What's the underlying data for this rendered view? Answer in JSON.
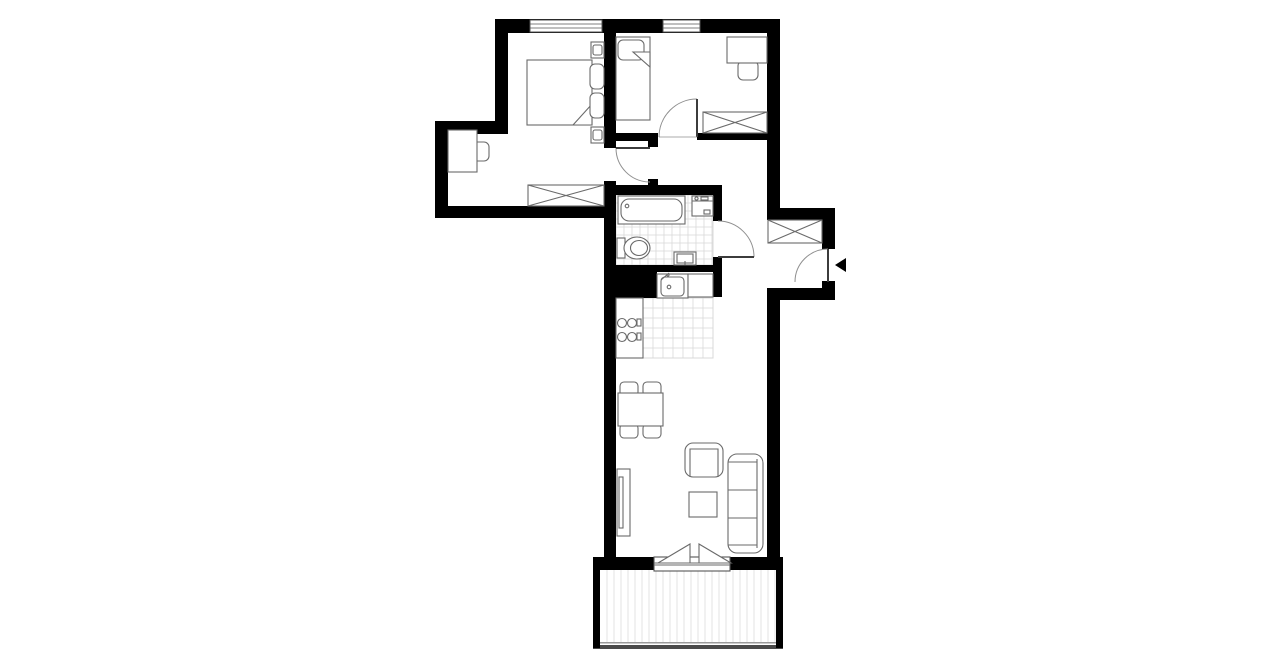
{
  "canvas": {
    "w": 1280,
    "h": 667,
    "bg": "#ffffff"
  },
  "palette": {
    "wall": "#000000",
    "line": "#6a6a6a",
    "leaf": "#3c3c3c",
    "arc": "#8f8f8f",
    "tile": "#d8d8d8",
    "deck": "#e3e3e3",
    "rail_light": "#9a9a9a",
    "rail_dark": "#4a4a4a",
    "window_frame": "#555555",
    "white": "#ffffff"
  },
  "walls": [
    {
      "name": "top-wall",
      "r": [
        495,
        19,
        285,
        14
      ]
    },
    {
      "name": "bedroom1-left-wall-upper",
      "r": [
        495,
        19,
        13,
        102
      ]
    },
    {
      "name": "bedroom1-step-wall",
      "r": [
        435,
        121,
        73,
        13
      ]
    },
    {
      "name": "bedroom1-left-wall-lower",
      "r": [
        435,
        121,
        13,
        97
      ]
    },
    {
      "name": "bedroom1-bottom-wall",
      "r": [
        435,
        206,
        181,
        12
      ]
    },
    {
      "name": "bedroom-divider-wall",
      "r": [
        604,
        33,
        12,
        115
      ]
    },
    {
      "name": "core-left-wall",
      "r": [
        604,
        181,
        12,
        389
      ]
    },
    {
      "name": "bedroom2-bottom-wall-left",
      "r": [
        616,
        133,
        42,
        8
      ]
    },
    {
      "name": "bedroom2-doorstop-nub",
      "r": [
        648,
        140,
        10,
        7
      ]
    },
    {
      "name": "bedroom2-bottom-wall-right",
      "r": [
        697,
        133,
        70,
        7
      ]
    },
    {
      "name": "right-wall-upper",
      "r": [
        767,
        19,
        13,
        201
      ]
    },
    {
      "name": "entry-step-wall",
      "r": [
        767,
        208,
        68,
        12
      ]
    },
    {
      "name": "entry-right-wall-upper",
      "r": [
        822,
        220,
        13,
        29
      ]
    },
    {
      "name": "entry-right-wall-stub",
      "r": [
        822,
        281,
        13,
        19
      ]
    },
    {
      "name": "entry-bottom-wall",
      "r": [
        767,
        288,
        68,
        12
      ]
    },
    {
      "name": "right-wall-lower",
      "r": [
        767,
        288,
        13,
        282
      ]
    },
    {
      "name": "bathroom-top-wall",
      "r": [
        616,
        185,
        106,
        10
      ]
    },
    {
      "name": "bathroom-doorstop-nub",
      "r": [
        648,
        179,
        10,
        6
      ]
    },
    {
      "name": "bathroom-right-wall-upper",
      "r": [
        713,
        195,
        9,
        26
      ]
    },
    {
      "name": "bathroom-right-wall-lower",
      "r": [
        713,
        257,
        9,
        15
      ]
    },
    {
      "name": "bathroom-bottom-wall",
      "r": [
        604,
        265,
        118,
        7
      ]
    },
    {
      "name": "kitchen-shaft",
      "r": [
        604,
        272,
        53,
        26
      ]
    },
    {
      "name": "kitchen-right-wall",
      "r": [
        713,
        272,
        9,
        25
      ]
    },
    {
      "name": "living-bottom-wall-left",
      "r": [
        593,
        557,
        61,
        13
      ]
    },
    {
      "name": "living-bottom-wall-right",
      "r": [
        730,
        557,
        53,
        13
      ]
    },
    {
      "name": "balcony-left-wall",
      "r": [
        593,
        570,
        7,
        78
      ]
    },
    {
      "name": "balcony-right-wall",
      "r": [
        776,
        570,
        7,
        78
      ]
    }
  ],
  "windows": [
    {
      "name": "bedroom1-window",
      "r": [
        530,
        20,
        72,
        12
      ]
    },
    {
      "name": "bedroom2-window",
      "r": [
        663,
        20,
        37,
        12
      ]
    }
  ],
  "tiles": [
    {
      "name": "bathroom-floor",
      "r": [
        616,
        195,
        97,
        70
      ],
      "size": 8
    },
    {
      "name": "kitchen-floor",
      "r": [
        643,
        298,
        70,
        60
      ],
      "size": 10
    }
  ],
  "balcony": {
    "deck": [
      600,
      570,
      176,
      72
    ],
    "deck_spacing": 7,
    "rail_top": [
      593,
      642,
      190,
      1.5
    ],
    "rail_bottom": [
      593,
      645,
      190,
      4
    ]
  },
  "doors": [
    {
      "name": "bedroom1-door",
      "leaf": [
        616,
        148,
        650,
        148
      ],
      "arc": "M 616 148 A 34 34 0 0 0 650 182"
    },
    {
      "name": "bedroom2-door",
      "leaf": [
        697,
        99,
        697,
        137
      ],
      "arc": "M 697 99 A 38 38 0 0 0 659 137",
      "threshold": [
        659,
        137,
        697,
        137
      ]
    },
    {
      "name": "bathroom-door",
      "leaf": [
        718,
        257,
        754,
        257
      ],
      "arc": "M 754 257 A 36 36 0 0 0 718 221"
    },
    {
      "name": "entrance-door",
      "leaf": [
        828,
        249,
        828,
        282
      ],
      "arc": "M 795 282 A 33 33 0 0 1 828 249"
    }
  ],
  "furniture": [
    {
      "name": "bedroom1-desk-chair",
      "shapes": [
        {
          "t": "rect",
          "r": [
            469,
            142,
            20,
            19
          ],
          "rx": 5,
          "f": "#fff"
        }
      ]
    },
    {
      "name": "bedroom1-desk",
      "shapes": [
        {
          "t": "rect",
          "r": [
            448,
            130,
            29,
            42
          ],
          "f": "#fff"
        }
      ]
    },
    {
      "name": "bedroom1-bed",
      "shapes": [
        {
          "t": "rect",
          "r": [
            527,
            60,
            65,
            65
          ],
          "f": "#fff"
        },
        {
          "t": "poly",
          "p": "573,125 592,104 592,125",
          "f": "#fff"
        },
        {
          "t": "rect",
          "r": [
            590,
            64,
            14,
            25
          ],
          "rx": 5,
          "f": "#fff"
        },
        {
          "t": "rect",
          "r": [
            590,
            93,
            14,
            25
          ],
          "rx": 5,
          "f": "#fff"
        }
      ]
    },
    {
      "name": "bedroom1-nightstand-top",
      "shapes": [
        {
          "t": "rect",
          "r": [
            591,
            42,
            13,
            16
          ],
          "f": "#fff"
        },
        {
          "t": "rect",
          "r": [
            593,
            45,
            9,
            10
          ],
          "rx": 2
        }
      ]
    },
    {
      "name": "bedroom1-nightstand-bottom",
      "shapes": [
        {
          "t": "rect",
          "r": [
            591,
            127,
            13,
            16
          ],
          "f": "#fff"
        },
        {
          "t": "rect",
          "r": [
            593,
            130,
            9,
            10
          ],
          "rx": 2
        }
      ]
    },
    {
      "name": "bedroom1-wardrobe",
      "shapes": [
        {
          "t": "rect",
          "r": [
            528,
            185,
            76,
            21
          ],
          "f": "#fff"
        },
        {
          "t": "line",
          "p": [
            528,
            185,
            604,
            206
          ]
        },
        {
          "t": "line",
          "p": [
            604,
            185,
            528,
            206
          ]
        }
      ]
    },
    {
      "name": "bedroom2-bed",
      "shapes": [
        {
          "t": "rect",
          "r": [
            616,
            37,
            34,
            83
          ],
          "f": "#fff"
        },
        {
          "t": "rect",
          "r": [
            618,
            40,
            26,
            20
          ],
          "rx": 5,
          "f": "#fff"
        },
        {
          "t": "poly",
          "p": "633,52 650,52 650,67",
          "f": "#fff"
        }
      ]
    },
    {
      "name": "bedroom2-desk-chair",
      "shapes": [
        {
          "t": "rect",
          "r": [
            738,
            61,
            20,
            19
          ],
          "rx": 5,
          "f": "#fff"
        }
      ]
    },
    {
      "name": "bedroom2-desk",
      "shapes": [
        {
          "t": "rect",
          "r": [
            727,
            37,
            40,
            26
          ],
          "f": "#fff"
        }
      ]
    },
    {
      "name": "bedroom2-wardrobe",
      "shapes": [
        {
          "t": "rect",
          "r": [
            703,
            112,
            64,
            21
          ],
          "f": "#fff"
        },
        {
          "t": "line",
          "p": [
            703,
            112,
            767,
            133
          ]
        },
        {
          "t": "line",
          "p": [
            767,
            112,
            703,
            133
          ]
        }
      ]
    },
    {
      "name": "entry-wardrobe",
      "shapes": [
        {
          "t": "rect",
          "r": [
            768,
            220,
            54,
            23
          ],
          "f": "#fff"
        },
        {
          "t": "line",
          "p": [
            768,
            220,
            822,
            243
          ]
        },
        {
          "t": "line",
          "p": [
            822,
            220,
            768,
            243
          ]
        }
      ]
    },
    {
      "name": "bathtub",
      "shapes": [
        {
          "t": "rect",
          "r": [
            618,
            196,
            67,
            28
          ],
          "f": "#fff"
        },
        {
          "t": "rect",
          "r": [
            621,
            199,
            61,
            22
          ],
          "rx": 8
        },
        {
          "t": "circle",
          "c": [
            627,
            206,
            1.8
          ]
        }
      ]
    },
    {
      "name": "washing-machine",
      "shapes": [
        {
          "t": "rect",
          "r": [
            692,
            196,
            21,
            20
          ],
          "f": "#fff"
        },
        {
          "t": "line",
          "p": [
            692,
            201,
            713,
            201
          ]
        },
        {
          "t": "circle",
          "c": [
            696.5,
            198.5,
            1.6
          ]
        },
        {
          "t": "rect",
          "r": [
            701,
            197,
            7,
            3
          ]
        },
        {
          "t": "rect",
          "r": [
            704,
            210,
            6,
            4
          ]
        }
      ]
    },
    {
      "name": "toilet",
      "shapes": [
        {
          "t": "rect",
          "r": [
            617,
            238,
            8,
            20
          ],
          "f": "#fff"
        },
        {
          "t": "ellipse",
          "c": [
            637,
            248,
            13,
            11
          ],
          "f": "#fff"
        },
        {
          "t": "ellipse",
          "c": [
            639,
            248,
            8.5,
            7.5
          ]
        }
      ]
    },
    {
      "name": "bathroom-sink",
      "shapes": [
        {
          "t": "rect",
          "r": [
            674,
            252,
            22,
            13
          ],
          "f": "#fff"
        },
        {
          "t": "rect",
          "r": [
            677,
            254,
            16,
            9
          ]
        },
        {
          "t": "line",
          "p": [
            685,
            261,
            685,
            265
          ]
        }
      ]
    },
    {
      "name": "kitchen-sink",
      "shapes": [
        {
          "t": "rect",
          "r": [
            657,
            274,
            31,
            24
          ],
          "f": "#fff"
        },
        {
          "t": "rect",
          "r": [
            661,
            277,
            23,
            19
          ],
          "rx": 4
        },
        {
          "t": "circle",
          "c": [
            669,
            287,
            1.8
          ]
        },
        {
          "t": "line",
          "p": [
            661,
            280,
            669,
            273
          ]
        },
        {
          "t": "circle",
          "c": [
            668,
            275,
            1
          ]
        }
      ]
    },
    {
      "name": "kitchen-counter",
      "shapes": [
        {
          "t": "rect",
          "r": [
            688,
            274,
            25,
            23
          ],
          "f": "#fff"
        }
      ]
    },
    {
      "name": "stove",
      "shapes": [
        {
          "t": "rect",
          "r": [
            616,
            298,
            27,
            60
          ],
          "f": "#fff"
        },
        {
          "t": "circle",
          "c": [
            622,
            323,
            4.5
          ]
        },
        {
          "t": "circle",
          "c": [
            632,
            323,
            4.5
          ]
        },
        {
          "t": "circle",
          "c": [
            622,
            337,
            4.5
          ]
        },
        {
          "t": "circle",
          "c": [
            632,
            337,
            4.5
          ]
        },
        {
          "t": "rect",
          "r": [
            637,
            319,
            4,
            7
          ]
        },
        {
          "t": "rect",
          "r": [
            637,
            333,
            4,
            7
          ]
        }
      ]
    },
    {
      "name": "dining-chair-1",
      "shapes": [
        {
          "t": "rect",
          "r": [
            620,
            382,
            18,
            14
          ],
          "rx": 4,
          "f": "#fff"
        }
      ]
    },
    {
      "name": "dining-chair-2",
      "shapes": [
        {
          "t": "rect",
          "r": [
            643,
            382,
            18,
            14
          ],
          "rx": 4,
          "f": "#fff"
        }
      ]
    },
    {
      "name": "dining-chair-3",
      "shapes": [
        {
          "t": "rect",
          "r": [
            620,
            424,
            18,
            14
          ],
          "rx": 4,
          "f": "#fff"
        }
      ]
    },
    {
      "name": "dining-chair-4",
      "shapes": [
        {
          "t": "rect",
          "r": [
            643,
            424,
            18,
            14
          ],
          "rx": 4,
          "f": "#fff"
        }
      ]
    },
    {
      "name": "dining-table",
      "shapes": [
        {
          "t": "rect",
          "r": [
            618,
            393,
            45,
            33
          ],
          "f": "#fff"
        }
      ]
    },
    {
      "name": "tv-cabinet",
      "shapes": [
        {
          "t": "rect",
          "r": [
            617,
            469,
            13,
            67
          ],
          "f": "#fff"
        },
        {
          "t": "rect",
          "r": [
            619,
            477,
            4,
            51
          ],
          "f": "#fff"
        }
      ]
    },
    {
      "name": "armchair",
      "shapes": [
        {
          "t": "rect",
          "r": [
            685,
            443,
            38,
            34
          ],
          "rx": 8,
          "f": "#fff"
        },
        {
          "t": "path",
          "d": "M 690 477 L 690 449 L 718 449 L 718 477"
        }
      ]
    },
    {
      "name": "coffee-table",
      "shapes": [
        {
          "t": "rect",
          "r": [
            689,
            492,
            28,
            25
          ],
          "f": "#fff"
        }
      ]
    },
    {
      "name": "sofa",
      "shapes": [
        {
          "t": "rect",
          "r": [
            728,
            454,
            35,
            99
          ],
          "rx": 9,
          "f": "#fff"
        },
        {
          "t": "line",
          "p": [
            757,
            459,
            757,
            548
          ]
        },
        {
          "t": "line",
          "p": [
            728,
            462,
            757,
            462
          ]
        },
        {
          "t": "line",
          "p": [
            728,
            545,
            757,
            545
          ]
        },
        {
          "t": "line",
          "p": [
            728,
            490,
            757,
            490
          ]
        },
        {
          "t": "line",
          "p": [
            728,
            518,
            757,
            518
          ]
        }
      ]
    },
    {
      "name": "balcony-door",
      "shapes": [
        {
          "t": "rect",
          "r": [
            654,
            557,
            76,
            14
          ],
          "f": "#fff",
          "s": "#555555"
        },
        {
          "t": "line",
          "p": [
            654,
            565,
            730,
            565
          ]
        },
        {
          "t": "poly",
          "p": "658,563 690,544 690,563",
          "f": "#fff"
        },
        {
          "t": "poly",
          "p": "699,544 699,563 731,563",
          "f": "#fff"
        },
        {
          "t": "line",
          "p": [
            654,
            563,
            730,
            563
          ]
        }
      ]
    },
    {
      "name": "entrance-arrow",
      "shapes": [
        {
          "t": "poly",
          "p": "835,265 846,258 846,272",
          "f": "#000000",
          "s": "none"
        }
      ]
    }
  ]
}
